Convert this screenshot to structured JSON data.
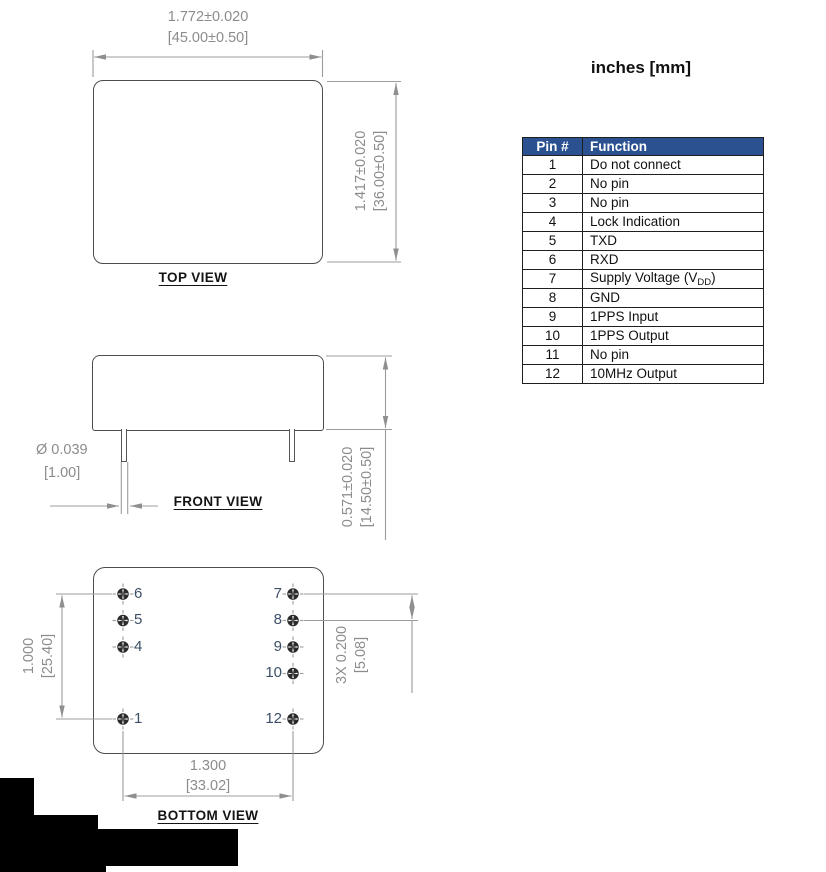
{
  "units_label": "inches [mm]",
  "pin_table": {
    "headers": [
      "Pin #",
      "Function"
    ],
    "rows": [
      {
        "pin": "1",
        "function": "Do not connect"
      },
      {
        "pin": "2",
        "function": "No pin"
      },
      {
        "pin": "3",
        "function": "No pin"
      },
      {
        "pin": "4",
        "function": "Lock Indication"
      },
      {
        "pin": "5",
        "function": "TXD"
      },
      {
        "pin": "6",
        "function": "RXD"
      },
      {
        "pin": "7",
        "function": "Supply Voltage (V",
        "function_sub": "DD",
        "function_end": ")"
      },
      {
        "pin": "8",
        "function": "GND"
      },
      {
        "pin": "9",
        "function": "1PPS Input"
      },
      {
        "pin": "10",
        "function": "1PPS Output"
      },
      {
        "pin": "11",
        "function": "No pin"
      },
      {
        "pin": "12",
        "function": "10MHz Output"
      }
    ]
  },
  "top_view": {
    "label": "TOP VIEW",
    "width_in": "1.772±0.020",
    "width_mm": "[45.00±0.50]",
    "height_in": "1.417±0.020",
    "height_mm": "[36.00±0.50]"
  },
  "front_view": {
    "label": "FRONT VIEW",
    "pin_dia_in": "Ø 0.039",
    "pin_dia_mm": "[1.00]",
    "height_in": "0.571±0.020",
    "height_mm": "[14.50±0.50]"
  },
  "bottom_view": {
    "label": "BOTTOM VIEW",
    "left_pins": [
      "6",
      "5",
      "4",
      "1"
    ],
    "right_pins": [
      "7",
      "8",
      "9",
      "10",
      "12"
    ],
    "vert_pitch_in": "1.000",
    "vert_pitch_mm": "[25.40]",
    "row_pitch_in": "3X 0.200",
    "row_pitch_mm": "[5.08]",
    "horiz_span_in": "1.300",
    "horiz_span_mm": "[33.02]"
  },
  "colors": {
    "table_header_bg": "#2b5191",
    "table_header_text": "#ffffff",
    "dim_text": "#8c8c8c",
    "outline": "#4d4d4d",
    "pin_number": "#3d4f66",
    "redaction": "#000000"
  }
}
